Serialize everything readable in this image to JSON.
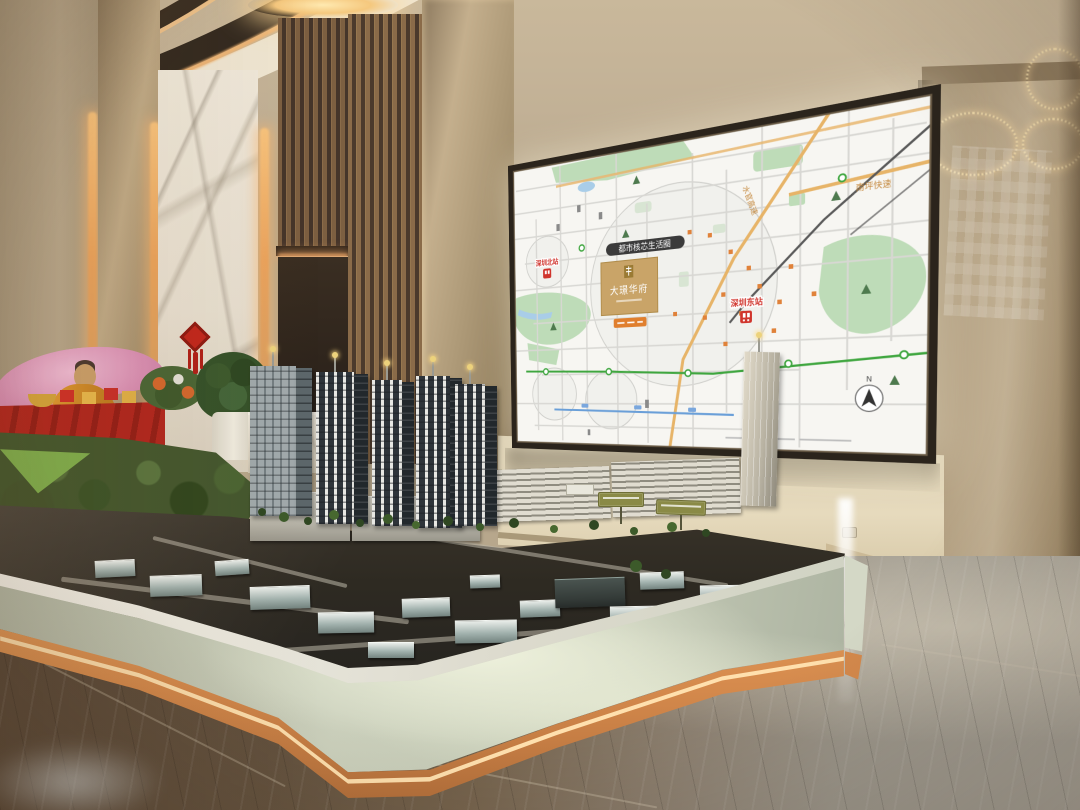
{
  "led_map": {
    "zone_pill_label": "都市核芯生活圈",
    "project_name": "大璟华府",
    "station_east": "深圳东站",
    "station_north": "深圳北站",
    "road_nanping": "南坪快速",
    "road_shuiguan": "水官高速",
    "compass_label": "N",
    "colors": {
      "background": "#f7f6f2",
      "park_green": "#bedcb8",
      "water_blue": "#a9cde8",
      "road_gray": "#d8d7d3",
      "expressway_orange": "#e7b468",
      "project_gold": "#c9a468",
      "station_red": "#d0342c",
      "metro_green": "#3fa63f",
      "label_pill_dark": "#3b3b3b"
    }
  },
  "environment_colors": {
    "wall_beige": "#b7a78c",
    "marble_white": "#e9e3d8",
    "wood_slat_dark": "#46362a",
    "cove_glow": "#f3b878",
    "fascia_sage": "#c6cbb7",
    "led_strip_copper": "#d88c50",
    "floor_brown": "#5a4b3e",
    "floor_gray": "#9a968c",
    "model_green": "#44582f",
    "chinese_knot_red": "#c1271d"
  }
}
